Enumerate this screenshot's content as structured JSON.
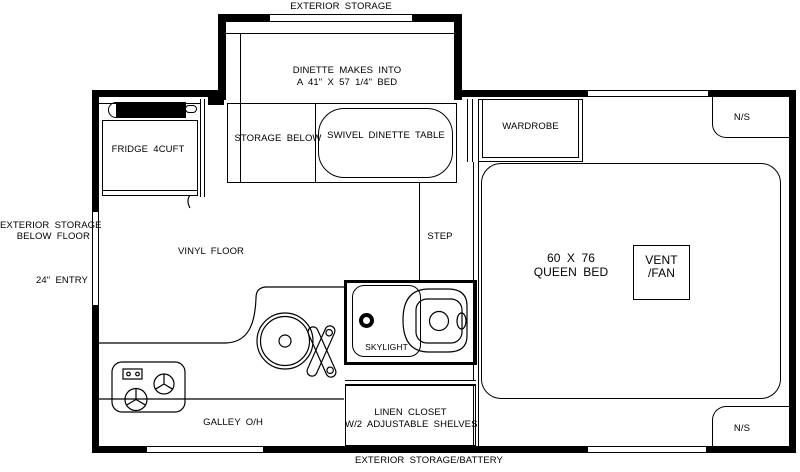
{
  "labels": {
    "exterior_storage_top": "EXTERIOR STORAGE",
    "dinette_line1": "DINETTE MAKES INTO",
    "dinette_line2": "A 41\" X 57 1/4\" BED",
    "storage_below": "STORAGE BELOW",
    "swivel_table": "SWIVEL DINETTE TABLE",
    "wardrobe": "WARDROBE",
    "ns_top": "N/S",
    "fridge": "FRIDGE 4CUFT",
    "ext_below_line1": "EXTERIOR STORAGE",
    "ext_below_line2": "BELOW FLOOR",
    "entry": "24\" ENTRY",
    "vinyl_floor": "VINYL FLOOR",
    "step": "STEP",
    "bed_line1": "60 X 76",
    "bed_line2": "QUEEN BED",
    "vent_line1": "VENT",
    "vent_line2": "/FAN",
    "skylight": "SKYLIGHT",
    "galley": "GALLEY O/H",
    "linen_line1": "LINEN CLOSET",
    "linen_line2": "W/2 ADJUSTABLE SHELVES",
    "ns_bottom": "N/S",
    "exterior_storage_battery": "EXTERIOR STORAGE/BATTERY"
  },
  "colors": {
    "wall": "#000000",
    "line": "#000000",
    "background": "#ffffff"
  }
}
